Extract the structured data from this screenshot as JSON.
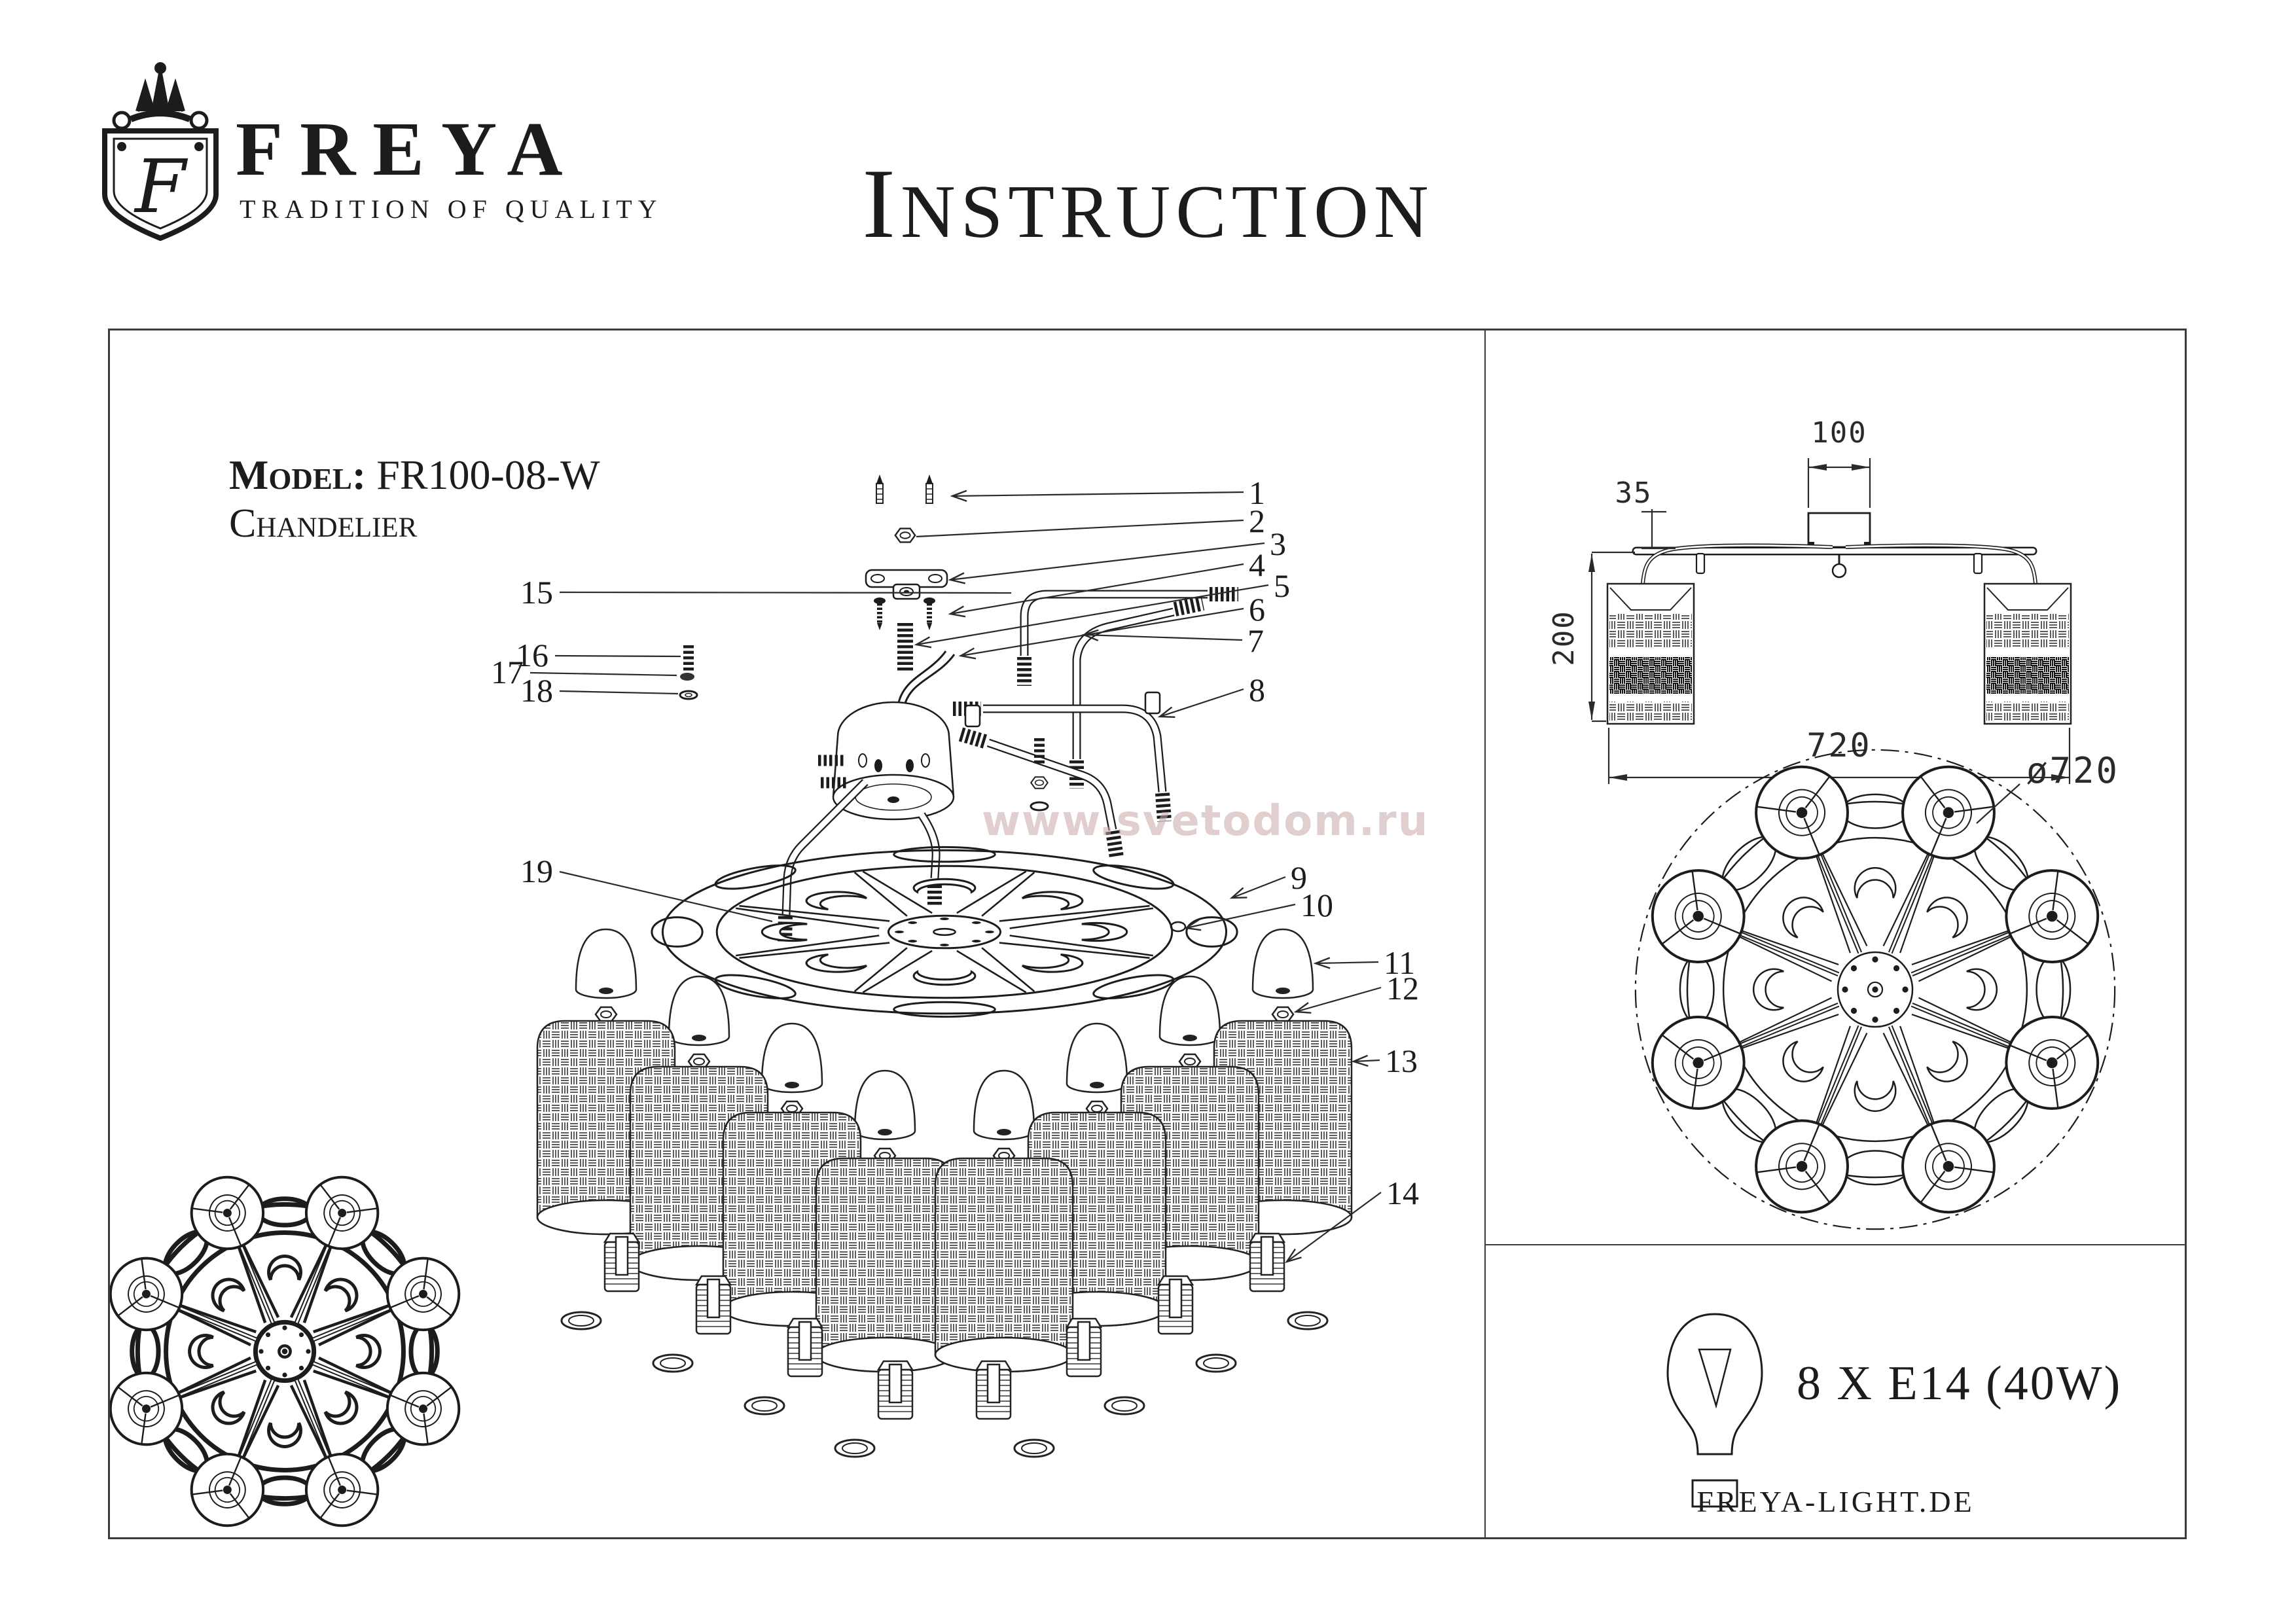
{
  "brand": {
    "monogram": "F",
    "name": "FREYA",
    "tagline": "TRADITION OF QUALITY"
  },
  "title": {
    "lead": "I",
    "rest": "NSTRUCTION"
  },
  "product": {
    "model_label": "Model:",
    "model_value": "FR100-08-W",
    "type_value": "Chandelier"
  },
  "watermark": "www.svetodom.ru",
  "exploded": {
    "labels": [
      "1",
      "2",
      "3",
      "4",
      "5",
      "6",
      "7",
      "8",
      "9",
      "10",
      "11",
      "12",
      "13",
      "14",
      "15",
      "16",
      "17",
      "18",
      "19"
    ]
  },
  "dimensions": {
    "canopy_width": "100",
    "canopy_height": "35",
    "fixture_height": "200",
    "fixture_width": "720",
    "diameter": "ø720"
  },
  "specs": {
    "lamp_count_type": "8 X E14 (40W)"
  },
  "footer": {
    "website": "FREYA-LIGHT.DE"
  },
  "colors": {
    "ink": "#1c1c1c",
    "watermark": "#c9a8a8"
  }
}
